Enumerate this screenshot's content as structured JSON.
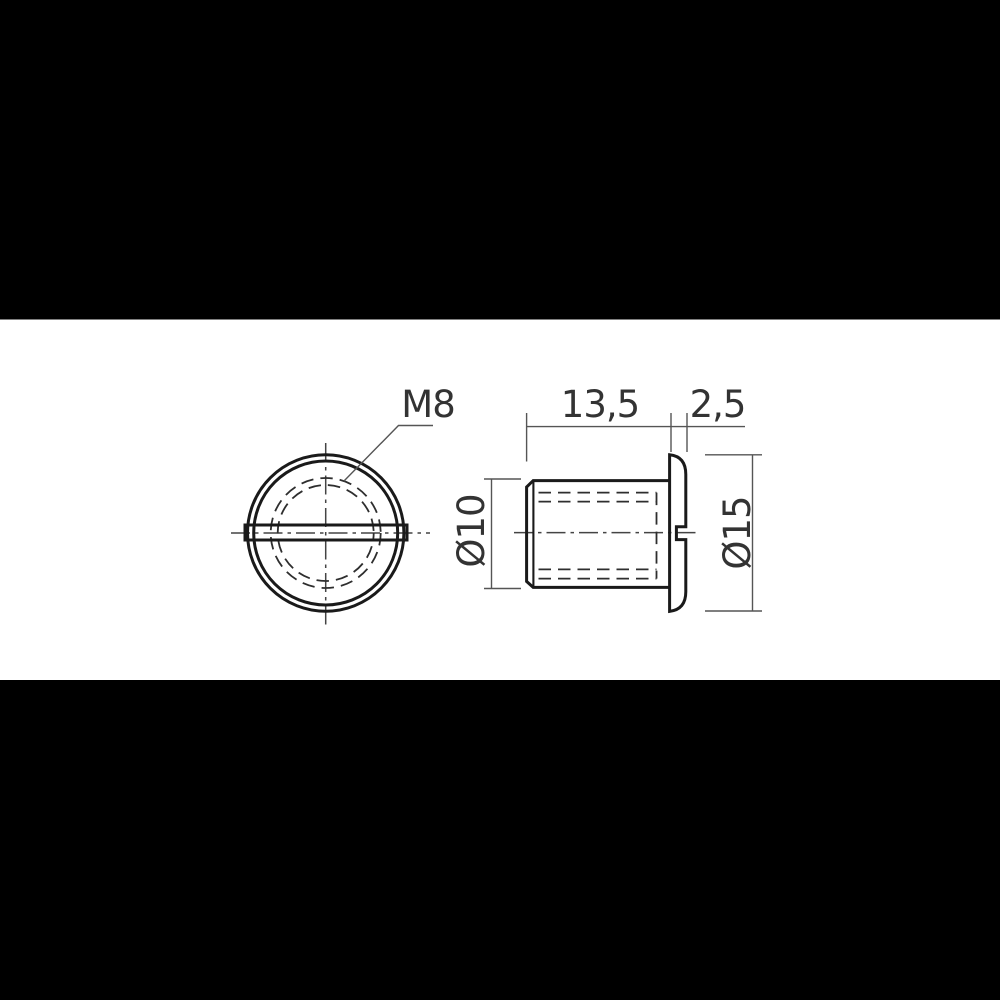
{
  "drawing": {
    "labels": {
      "thread": "M8",
      "body_length": "13,5",
      "flange_thickness": "2,5",
      "body_diameter": "Ø10",
      "flange_diameter": "Ø15"
    },
    "colors": {
      "letterbox": "#000000",
      "paper": "#ffffff",
      "outline": "#1a1a1a",
      "hidden": "#2e2e2e",
      "centerline": "#444444",
      "dim": "#555555",
      "text": "#333333"
    }
  }
}
